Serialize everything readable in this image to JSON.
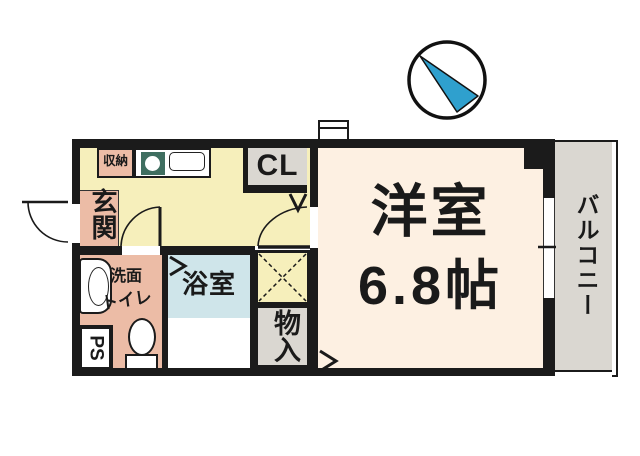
{
  "title": "apartment-floor-plan",
  "colors": {
    "wall": "#1b1b1b",
    "hall-yellow": "#f6efbb",
    "room-cream": "#fdf0e2",
    "salmon": "#ecbca6",
    "bath-blue": "#cfe5ea",
    "gray": "#dad7d1",
    "sink-green": "#3f6e60",
    "compass-blue": "#2fa0ce",
    "text": "#1a1a1a"
  },
  "rooms": {
    "western_room": {
      "name": "洋室",
      "size": "6.8帖"
    },
    "balcony": {
      "name": "バルコニー"
    },
    "entrance": {
      "name": "玄関"
    },
    "storage_small": {
      "name": "収納"
    },
    "closet": {
      "name": "CL"
    },
    "washroom_toilet": {
      "name_line1": "洗面",
      "name_line2": "トイレ"
    },
    "bathroom": {
      "name": "浴室"
    },
    "pipe_space": {
      "name": "PS"
    },
    "storage_closet": {
      "name": "物入"
    }
  }
}
